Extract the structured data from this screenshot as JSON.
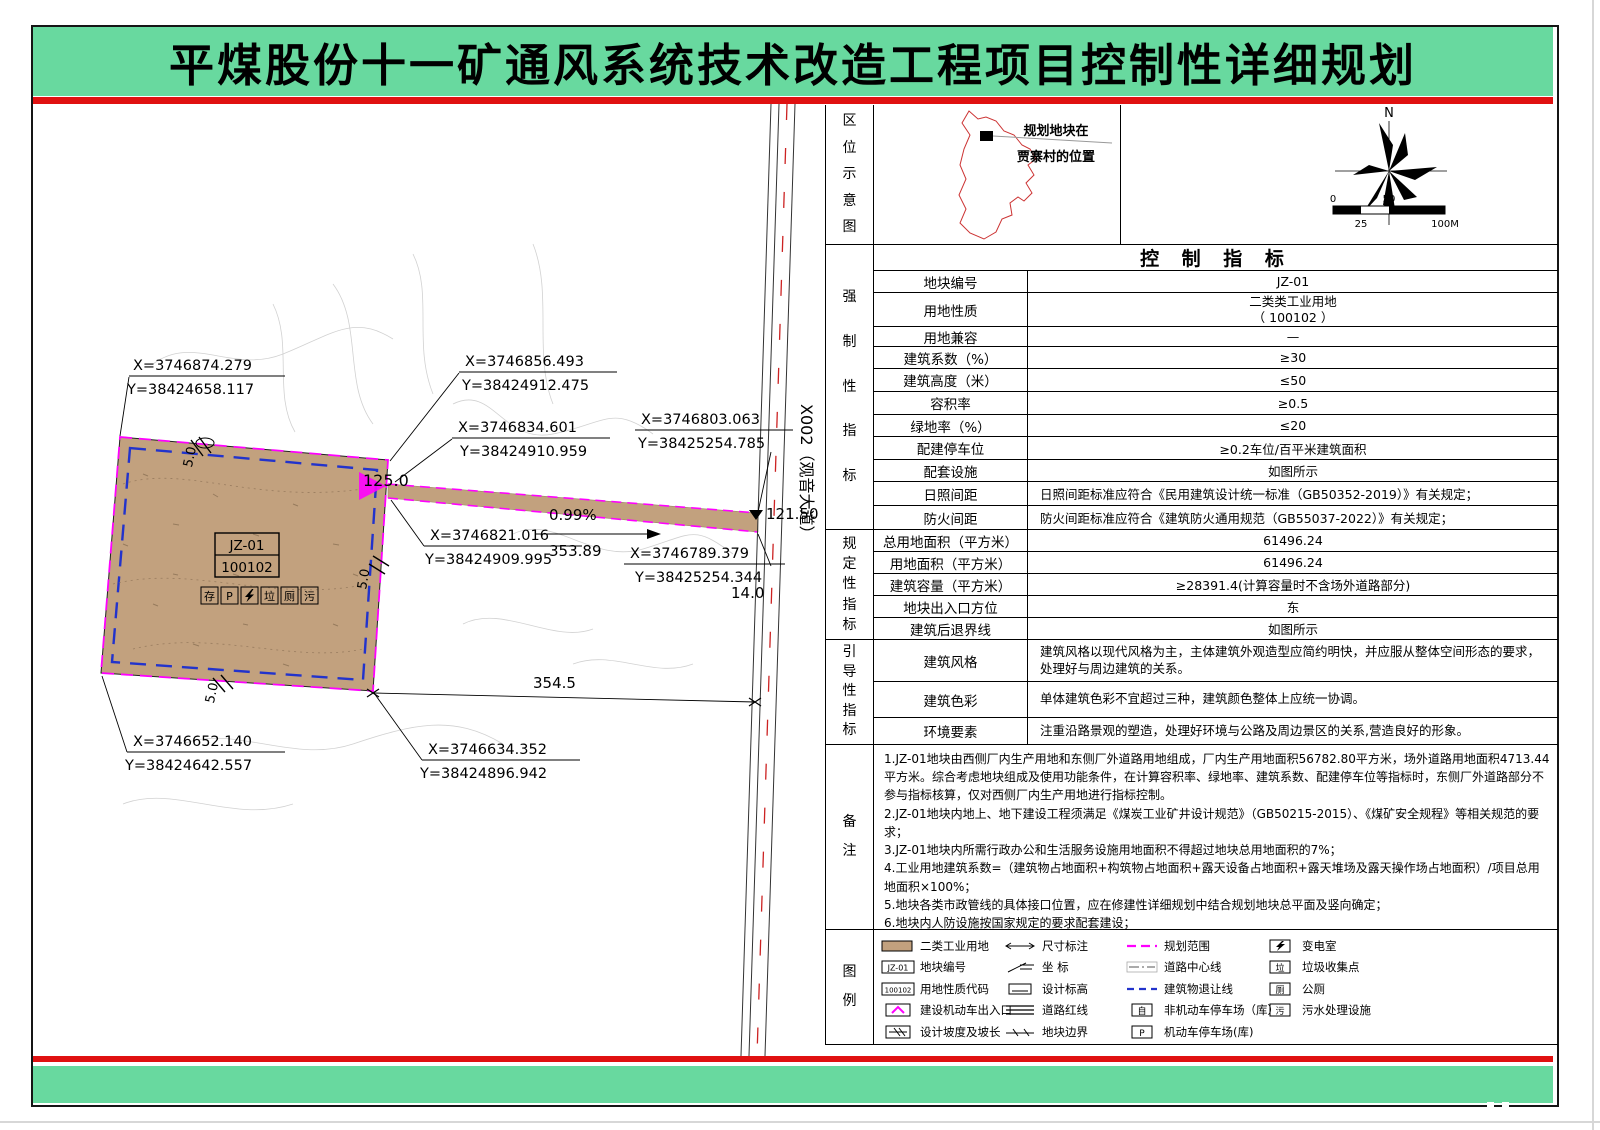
{
  "title": "平煤股份十一矿通风系统技术改造工程项目控制性详细规划",
  "location": {
    "label": "区位示意图",
    "callout_line1": "规划地块在",
    "callout_line2": "贾寨村的位置",
    "north": "N",
    "scale_0": "0",
    "scale_50": "50",
    "scale_25": "25",
    "scale_100": "100M"
  },
  "table": {
    "header": "控 制 指 标",
    "sec1_label": "强制性指标",
    "sec2_label": "规定性指标",
    "sec3_label": "引导性指标",
    "rows": {
      "r1": {
        "label": "地块编号",
        "value": "JZ-01"
      },
      "r2": {
        "label": "用地性质",
        "value": "二类类工业用地\n（ 100102 ）"
      },
      "r3": {
        "label": "用地兼容",
        "value": "—"
      },
      "r4": {
        "label": "建筑系数（%）",
        "value": "≥30"
      },
      "r5": {
        "label": "建筑高度（米）",
        "value": "≤50"
      },
      "r6": {
        "label": "容积率",
        "value": "≥0.5"
      },
      "r7": {
        "label": "绿地率（%）",
        "value": "≤20"
      },
      "r8": {
        "label": "配建停车位",
        "value": "≥0.2车位/百平米建筑面积"
      },
      "r9": {
        "label": "配套设施",
        "value": "如图所示"
      },
      "r10": {
        "label": "日照间距",
        "value": "日照间距标准应符合《民用建筑设计统一标准（GB50352-2019）》有关规定；"
      },
      "r11": {
        "label": "防火间距",
        "value": "防火间距标准应符合《建筑防火通用规范（GB55037-2022）》有关规定；"
      },
      "r12": {
        "label": "总用地面积（平方米）",
        "value": "61496.24"
      },
      "r13": {
        "label": "用地面积（平方米）",
        "value": "61496.24"
      },
      "r14": {
        "label": "建筑容量（平方米）",
        "value": "≥28391.4(计算容量时不含场外道路部分)"
      },
      "r15": {
        "label": "地块出入口方位",
        "value": "东"
      },
      "r16": {
        "label": "建筑后退界线",
        "value": "如图所示"
      },
      "r17": {
        "label": "建筑风格",
        "value": "建筑风格以现代风格为主，主体建筑外观造型应简约明快，并应服从整体空间形态的要求，处理好与周边建筑的关系。"
      },
      "r18": {
        "label": "建筑色彩",
        "value": "单体建筑色彩不宜超过三种，建筑颜色整体上应统一协调。"
      },
      "r19": {
        "label": "环境要素",
        "value": "注重沿路景观的塑造，处理好环境与公路及周边景区的关系,营造良好的形象。"
      }
    }
  },
  "notes": {
    "label": "备注",
    "items": [
      "1.JZ-01地块由西侧厂内生产用地和东侧厂外道路用地组成，厂内生产用地面积56782.80平方米，场外道路用地面积4713.44平方米。综合考虑地块组成及使用功能条件，在计算容积率、绿地率、建筑系数、配建停车位等指标时，东侧厂外道路部分不参与指标核算，仅对西侧厂内生产用地进行指标控制。",
      "2.JZ-01地块内地上、地下建设工程须满足《煤炭工业矿井设计规范》（GB50215-2015）、《煤矿安全规程》等相关规范的要求；",
      "3.JZ-01地块内所需行政办公和生活服务设施用地面积不得超过地块总用地面积的7%；",
      "4.工业用地建筑系数=（建筑物占地面积+构筑物占地面积+露天设备占地面积+露天堆场及露天操作场占地面积）/项目总用地面积×100%；",
      "5.地块各类市政管线的具体接口位置，应在修建性详细规划中结合规划地块总平面及竖向确定；",
      "6.地块内人防设施按国家规定的要求配套建设；",
      "7. 地块内新建民用建筑应达到绿色建筑标准和进行无障碍设计；",
      "8.本次规划确定的规划道路高程控制点依据地形图测量标高而设计，在开工建设时应进一步核实。"
    ]
  },
  "legend": {
    "label": "图例",
    "items": {
      "i1": "二类工业用地",
      "i2": "地块编号",
      "i3": "用地性质代码",
      "i4": "建设机动车出入口",
      "i5": "设计坡度及坡长",
      "i6": "尺寸标注",
      "i7": "坐    标",
      "i8": "设计标高",
      "i9": "道路红线",
      "i10": "地块边界",
      "i11": "规划范围",
      "i12": "道路中心线",
      "i13": "建筑物退让线",
      "i14": "非机动车停车场（库）",
      "i15": "机动车停车场(库)",
      "i16": "变电室",
      "i17": "垃圾收集点",
      "i18": "公厕",
      "i19": "污水处理设施"
    },
    "sym": {
      "jz": "JZ-01",
      "code": "100102",
      "p": "P",
      "bike": "自",
      "trash": "垃",
      "wc": "厕",
      "sewage": "污"
    }
  },
  "map": {
    "road_label": "X002（观音大道）",
    "parcel": {
      "code": "JZ-01",
      "use": "100102"
    },
    "icons": {
      "i1": "存",
      "i2": "P",
      "i4": "垃",
      "i5": "厕",
      "i6": "污"
    },
    "coords": {
      "c1x": "X=3746874.279",
      "c1y": "Y=38424658.117",
      "c2x": "X=3746856.493",
      "c2y": "Y=38424912.475",
      "c3x": "X=3746834.601",
      "c3y": "Y=38424910.959",
      "c4x": "X=3746803.063",
      "c4y": "Y=38425254.785",
      "c5x": "X=3746821.016",
      "c5y": "Y=38424909.995",
      "c6x": "X=3746789.379",
      "c6y": "Y=38425254.344",
      "c7x": "X=3746652.140",
      "c7y": "Y=38424642.557",
      "c8x": "X=3746634.352",
      "c8y": "Y=38424896.942"
    },
    "dims": {
      "d125": "125.0",
      "slope": "0.99%",
      "len": "353.89",
      "elev": "121.50",
      "w14": "14.0",
      "d354": "354.5",
      "s1": "5.0",
      "s2": "5.0",
      "s3": "5.0"
    }
  },
  "colors": {
    "banner": "#68D99F",
    "red": "#E01111",
    "parcel": "#C2A17E",
    "planning_boundary": "#FF00FF",
    "setback_line": "#2233CC"
  }
}
